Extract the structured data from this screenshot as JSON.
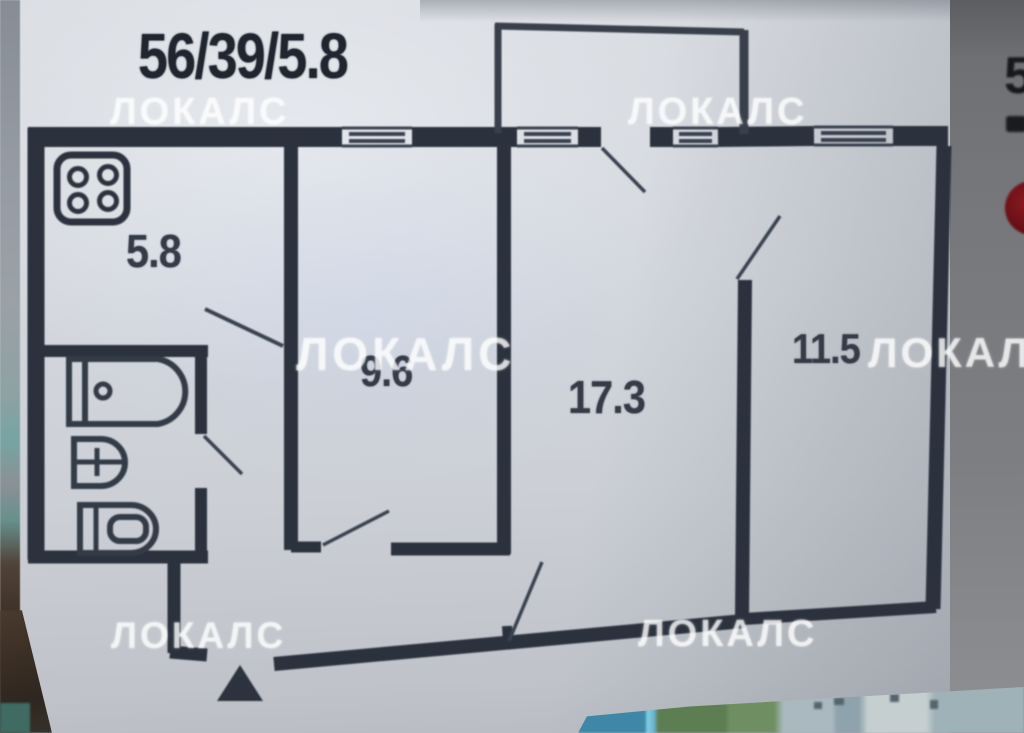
{
  "plan": {
    "title": "56/39/5.8",
    "watermark_text": "ЛОКАЛС",
    "rooms": {
      "kitchen": {
        "name": "kitchen",
        "area": "5.8"
      },
      "bedroom": {
        "name": "room",
        "area": "9.6"
      },
      "living": {
        "name": "living",
        "area": "17.3"
      },
      "bedroom2": {
        "name": "room",
        "area": "11.5"
      }
    }
  },
  "page_edge": {
    "fragment_text": "5"
  },
  "colors": {
    "wall": "#2b323e",
    "paper": "#d2d6dc",
    "watermark": "#ffffff",
    "accent_red": "#6e1118"
  }
}
